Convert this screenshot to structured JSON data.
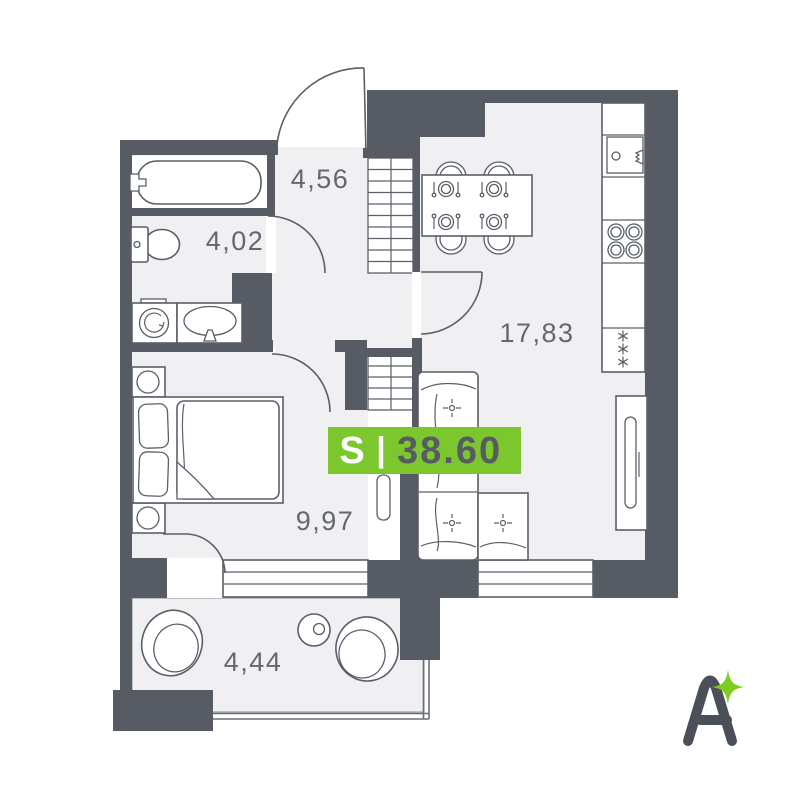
{
  "plan": {
    "title": "apartment-floor-plan",
    "rooms": [
      {
        "id": "hallway",
        "area": "4,56"
      },
      {
        "id": "bathroom",
        "area": "4,02"
      },
      {
        "id": "kitchen-living",
        "area": "17,83"
      },
      {
        "id": "bedroom",
        "area": "9,97"
      },
      {
        "id": "balcony",
        "area": "4,44"
      }
    ],
    "badge": {
      "label": "S",
      "separator": "|",
      "value": "38.60"
    }
  },
  "logo": {
    "letter": "A"
  },
  "colors": {
    "wall": "#565B64",
    "floor": "#F0F0F2",
    "line": "#5A5F68",
    "label_text": "#63676F",
    "badge_bg": "#7CC62E",
    "badge_value_text": "#575B64",
    "sparkle": "#7FCC21",
    "logo_letter": "#4A4F58",
    "background": "#FFFFFF"
  }
}
